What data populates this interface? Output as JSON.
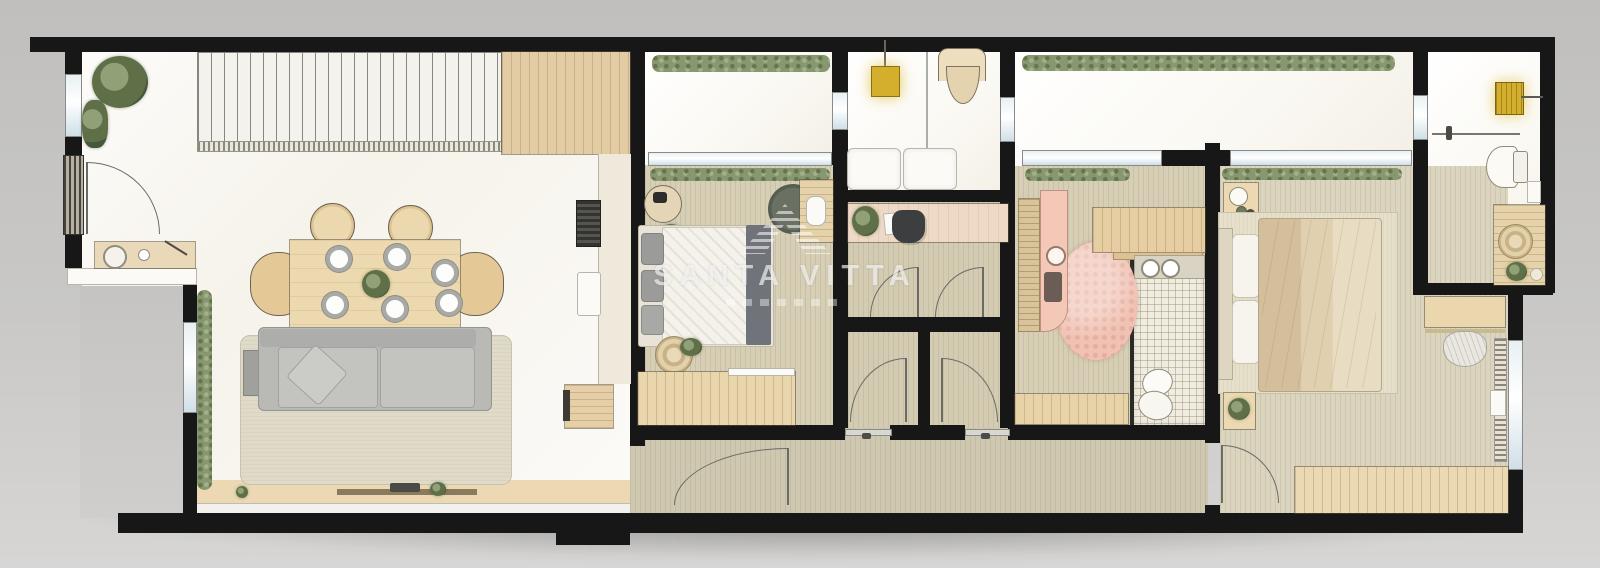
{
  "scene": {
    "type": "floor-plan",
    "view": "top-down-render",
    "areas": [
      "terrace-entry",
      "living-dining-room",
      "kitchen",
      "balcony-1",
      "terrace-lounge",
      "bedroom-1",
      "office",
      "storage-wc",
      "kitchenette-room",
      "bathroom",
      "master-bedroom",
      "service-area",
      "corridor"
    ]
  },
  "watermark": {
    "brand": "SANTA VITTA",
    "logo": "striped-roof-logo"
  },
  "palette": {
    "wall": "#171717",
    "marble": "#f8f5ee",
    "terrace": "#faf8f2",
    "wood_floor": "#d6ceb5",
    "corridor": "#cfc8b1",
    "master_floor": "#dbd4be",
    "tile": "#f0ece0",
    "deck": "#ecd9b4",
    "hedge": "#87976f",
    "sofa": "#b9b9b5",
    "rug": "#dfdbc8",
    "wood": "#e7d2a8",
    "pink_counter": "#f3c8b7",
    "pink_rug": "#f1c2b4",
    "yellow": "#d4af2e",
    "watermark": "rgba(255,255,255,0.62)"
  }
}
